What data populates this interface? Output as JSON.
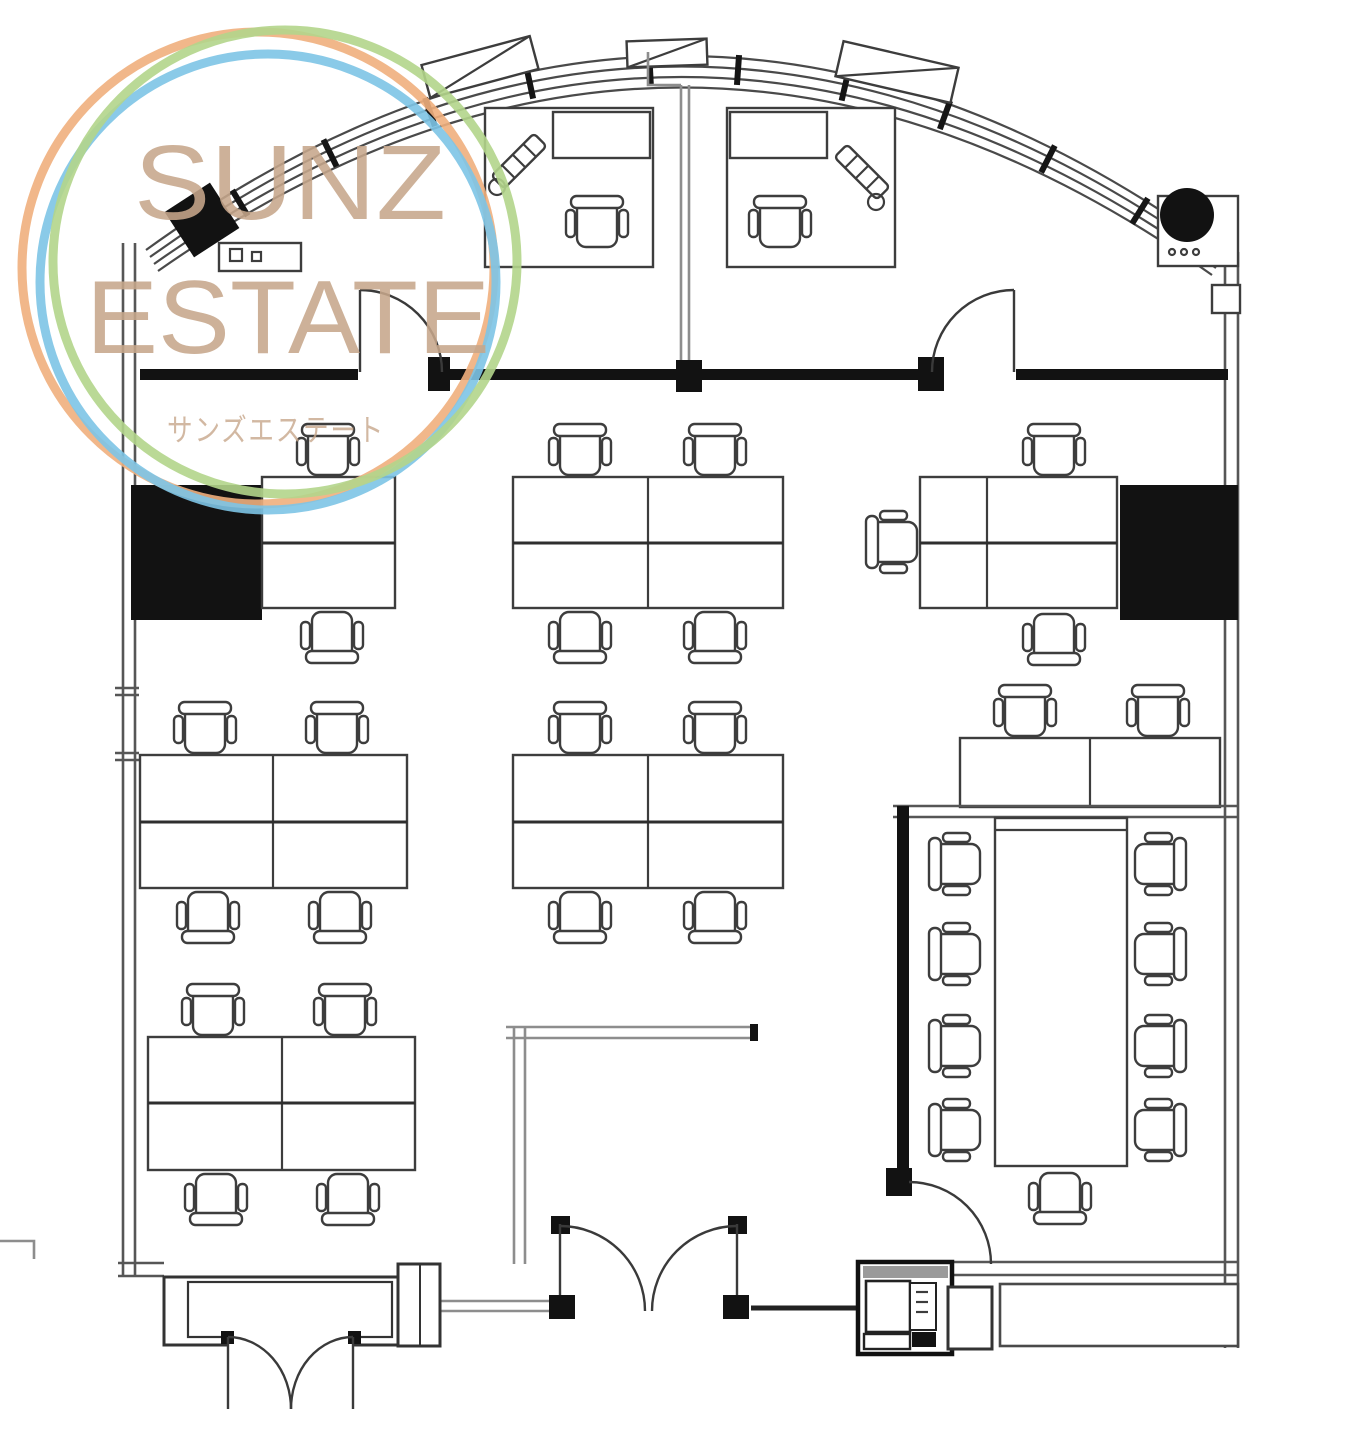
{
  "watermark": {
    "title_line1": "SUNZ",
    "title_line2": "ESTATE",
    "subtitle": "サンズエステート",
    "text_color": "#c7a78b",
    "rings": {
      "orange": "#f0af7d",
      "blue": "#7dc4e6",
      "green": "#b2d58b"
    }
  },
  "floorplan": {
    "background": "#ffffff",
    "ink_color": "#3d3d3d",
    "wall_color": "#121212",
    "partition_color": "#8d8d8d",
    "icons": {
      "office-chair-icon": "armchair seen in plan view",
      "desk-cluster-icon": "island of facing desks",
      "executive-workstation-icon": "L-shaped desk with chair and plant",
      "conference-table-icon": "long meeting table",
      "door-swing-icon": "quarter-circle door swing",
      "double-door-icon": "pair of meeting door swings",
      "column-icon": "solid structural column",
      "curtain-wall-icon": "curved window wall with mullions",
      "copier-icon": "service / copier unit"
    },
    "counts": {
      "desks": 26,
      "chairs": 34,
      "desk_clusters": 7,
      "executive_workstations": 2,
      "conference_chairs": 9,
      "columns": 4,
      "single_doors": 3,
      "double_doors": 2
    }
  }
}
